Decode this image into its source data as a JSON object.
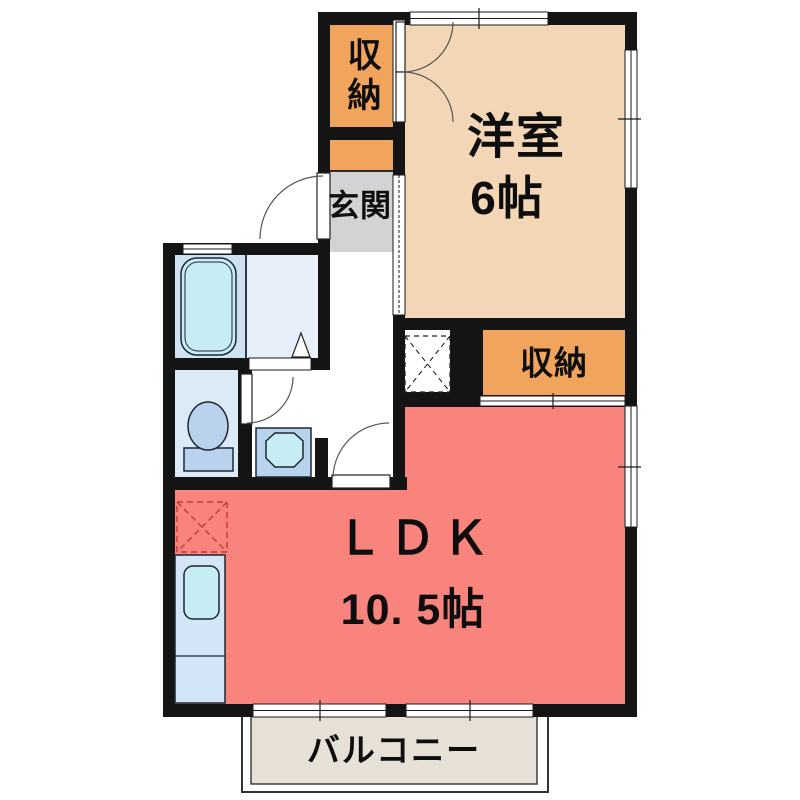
{
  "rooms": {
    "western_room": {
      "label": "洋室",
      "size": "6帖"
    },
    "ldk": {
      "label": "ＬＤＫ",
      "size": "10. 5帖"
    },
    "entrance": {
      "label": "玄関"
    },
    "closet_upper": {
      "label": "収納"
    },
    "closet_ldk": {
      "label": "収納"
    },
    "balcony": {
      "label": "バルコニー"
    }
  },
  "fixtures": {
    "bathtub": "bathtub-icon",
    "toilet": "toilet-icon",
    "washbasin": "washbasin-icon",
    "kitchen_sink": "kitchen-sink-icon",
    "washing_machine_space": "washing-machine-space-dashed-box",
    "refrigerator_space": "refrigerator-space-dashed-box"
  },
  "colors": {
    "wall": "#141414",
    "western_room": "#f3d6b6",
    "closet": "#f0a45c",
    "entrance": "#d2d3d5",
    "ldk": "#f9837d",
    "balcony": "#e6e0d6",
    "bath_floor": "#cfe2f2",
    "washroom_floor": "#e6effa",
    "toilet_floor": "#dce9f7",
    "fixture": "#b9d2ee",
    "water": "#c6edf3",
    "counter": "#d3e6f7",
    "fridge_outline": "#c03a3a"
  }
}
